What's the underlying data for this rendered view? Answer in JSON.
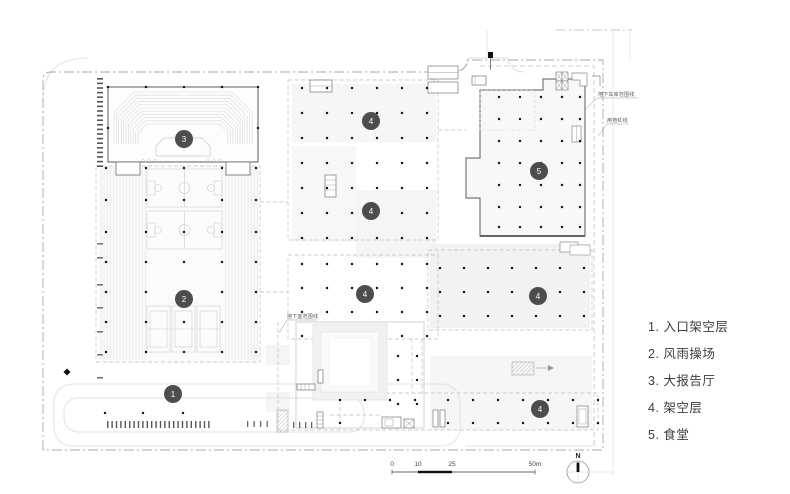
{
  "legend": {
    "items": [
      "1. 入口架空层",
      "2. 风雨操场",
      "3. 大报告厅",
      "4. 架空层",
      "5. 食堂"
    ]
  },
  "badges": [
    "3",
    "2",
    "1",
    "4",
    "4",
    "4",
    "5",
    "4",
    "4"
  ],
  "annotations": {
    "basement": "地下室范围线",
    "garage": "地下车库范围线",
    "red_line": "用地红线"
  },
  "scale_bar": {
    "ticks": [
      "0",
      "10",
      "25",
      "50m"
    ]
  },
  "compass": {
    "label": "N"
  },
  "colors": {
    "boundary": "#a8a8a8",
    "building_outline": "#787878",
    "badge_fill": "#4d4d4d",
    "column_dot": "#1a1a1a"
  }
}
